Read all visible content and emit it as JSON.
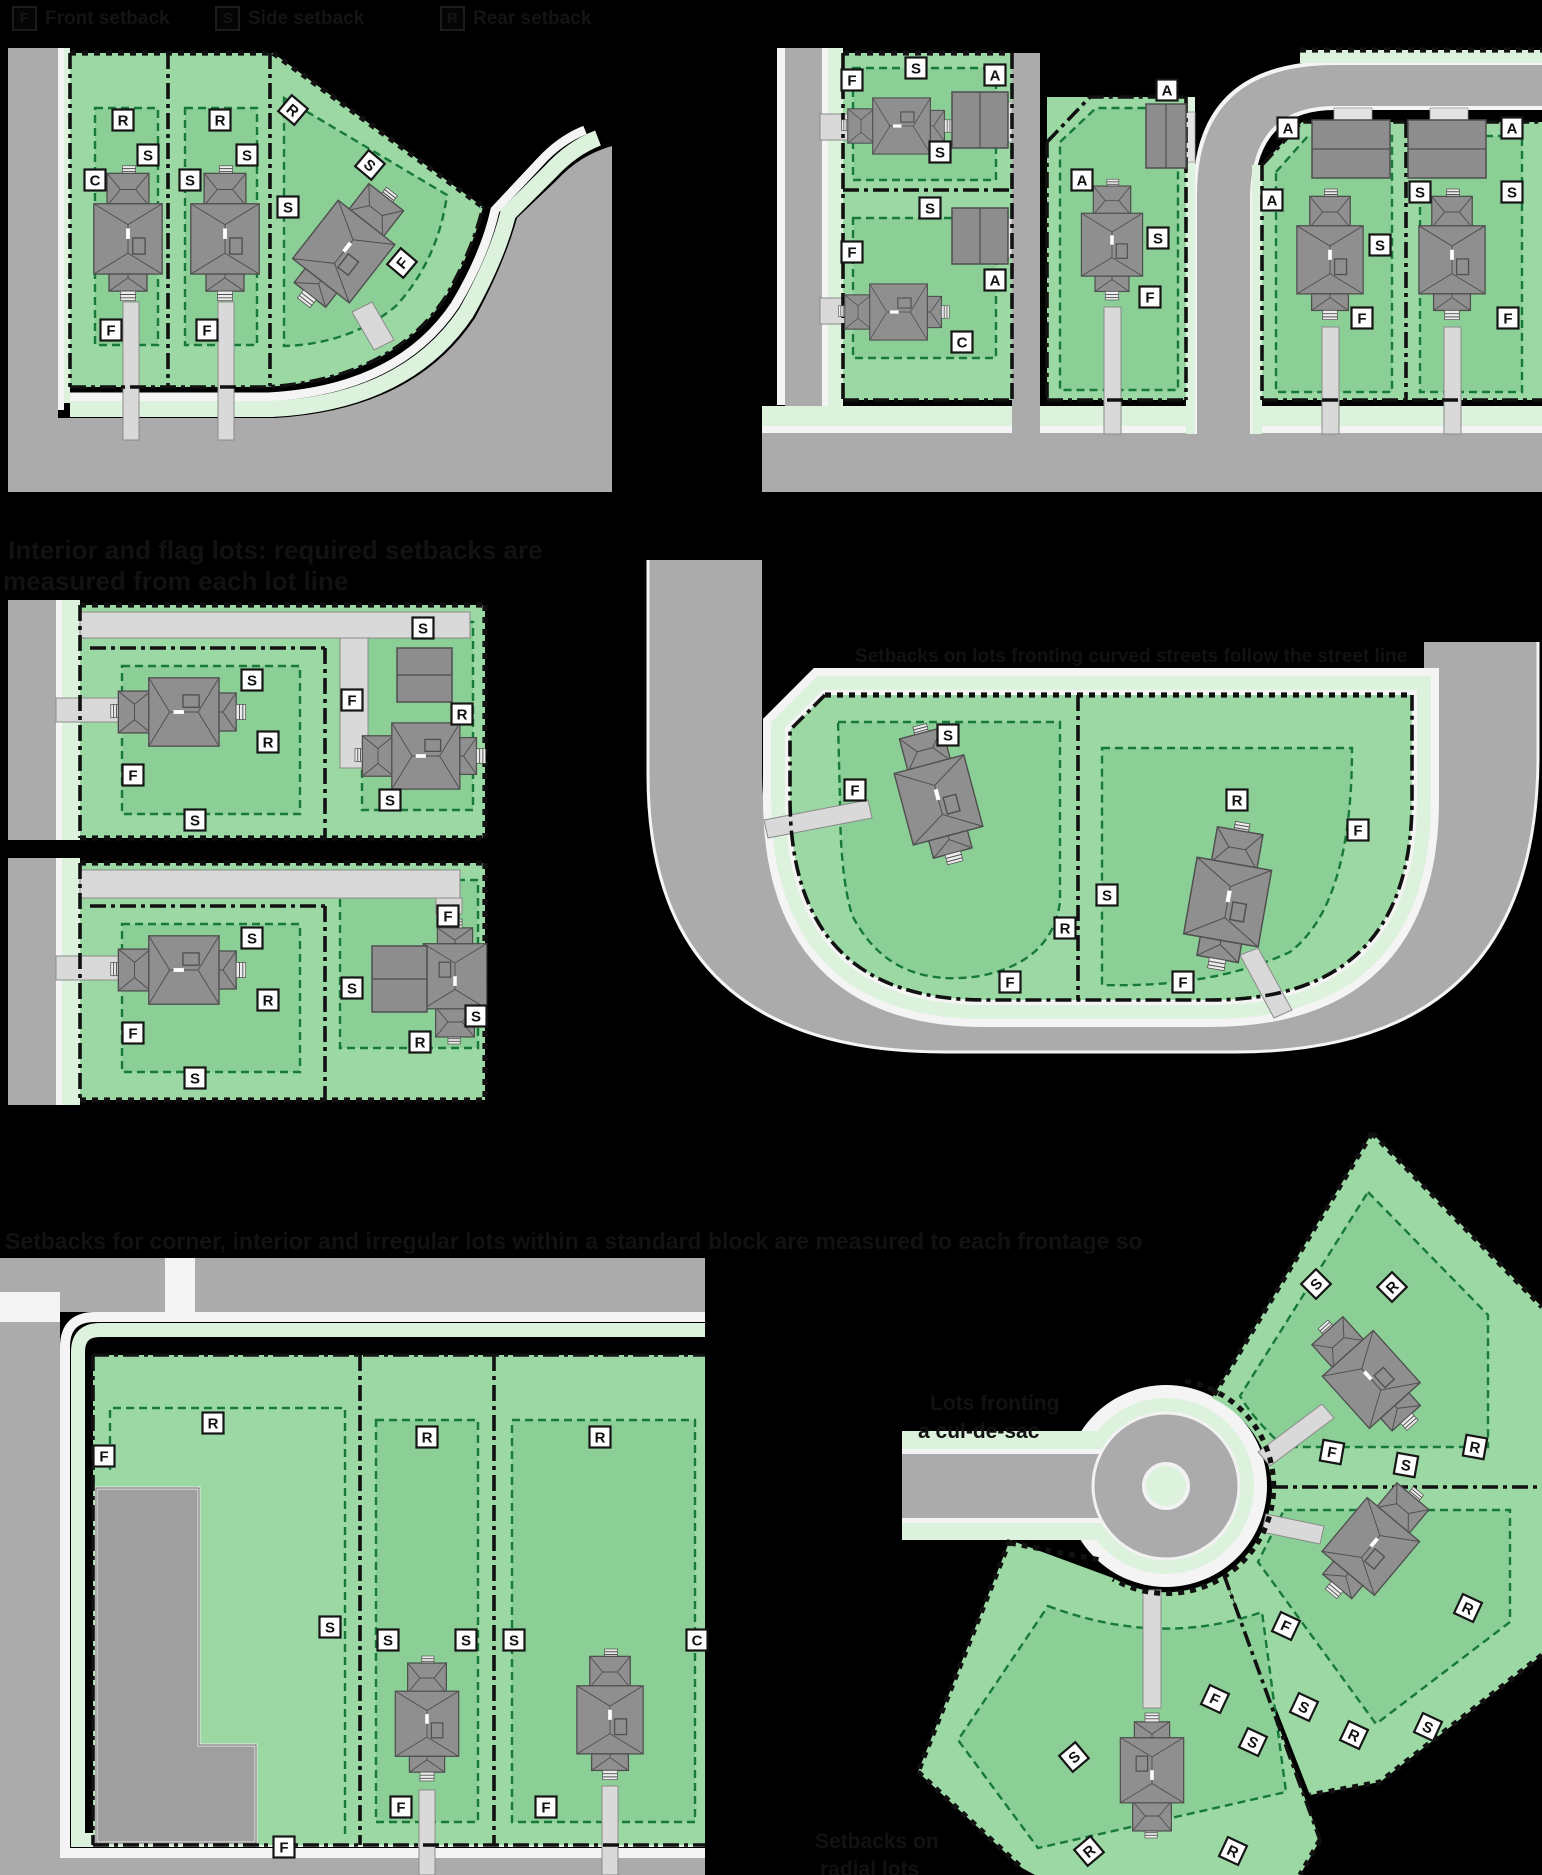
{
  "colors": {
    "background": "#000000",
    "road": "#ababab",
    "lot_green": "#9bd8a3",
    "buildable_green": "#8bcf96",
    "verge_green": "#dcf2dc",
    "sidewalk": "#f4f4f4",
    "setback_dash_green": "#17793a",
    "property_line": "#111111",
    "roof_gray": "#8f8f8f"
  },
  "legend": {
    "items": [
      {
        "letter": "F",
        "label": "Front setback",
        "left": 12
      },
      {
        "letter": "S",
        "label": "Side setback",
        "left": 215
      },
      {
        "letter": "R",
        "label": "Rear setback",
        "left": 440
      }
    ]
  },
  "captions": [
    {
      "id": "cap-mid-left-1",
      "text": "Interior and flag lots: required setbacks are",
      "x": 8,
      "y": 535,
      "size": 26
    },
    {
      "id": "cap-mid-left-2",
      "text": "measured from each lot line",
      "x": 3,
      "y": 566,
      "size": 26
    },
    {
      "id": "cap-mid-right",
      "text": "Setbacks on lots fronting curved streets follow the street line",
      "x": 855,
      "y": 646,
      "size": 19
    },
    {
      "id": "cap-bottom-left",
      "text": "Setbacks for corner, interior and irregular lots within a standard block are measured to each frontage so",
      "x": 5,
      "y": 1228,
      "size": 23
    },
    {
      "id": "note-culdesac-1",
      "text": "Lots fronting",
      "x": 930,
      "y": 1392,
      "size": 21
    },
    {
      "id": "note-culdesac-2",
      "text": "a cul-de-sac",
      "x": 918,
      "y": 1420,
      "size": 21
    },
    {
      "id": "note-radial-1",
      "text": "Setbacks on",
      "x": 815,
      "y": 1830,
      "size": 21
    },
    {
      "id": "note-radial-2",
      "text": "radial lots",
      "x": 820,
      "y": 1858,
      "size": 21
    }
  ],
  "panels": [
    {
      "id": "corner-lots",
      "name": "corner-lot-setbacks",
      "labels": [
        {
          "t": "R",
          "x": 123,
          "y": 120
        },
        {
          "t": "S",
          "x": 148,
          "y": 155
        },
        {
          "t": "C",
          "x": 95,
          "y": 180
        },
        {
          "t": "F",
          "x": 111,
          "y": 330
        },
        {
          "t": "R",
          "x": 220,
          "y": 120
        },
        {
          "t": "S",
          "x": 247,
          "y": 155
        },
        {
          "t": "S",
          "x": 190,
          "y": 180
        },
        {
          "t": "F",
          "x": 207,
          "y": 330
        },
        {
          "t": "R",
          "x": 293,
          "y": 110,
          "r": 40
        },
        {
          "t": "S",
          "x": 370,
          "y": 165,
          "r": 40
        },
        {
          "t": "S",
          "x": 288,
          "y": 207
        },
        {
          "t": "F",
          "x": 402,
          "y": 263,
          "r": -50
        }
      ],
      "houses": [
        {
          "x": 128,
          "y": 237,
          "r": 0,
          "s": 0.95
        },
        {
          "x": 225,
          "y": 237,
          "r": 0,
          "s": 0.95
        },
        {
          "x": 345,
          "y": 250,
          "r": 38,
          "s": 1.0
        }
      ],
      "garages": []
    },
    {
      "id": "alley-lots",
      "name": "alley-loaded-lot-setbacks",
      "labels": [
        {
          "t": "F",
          "x": 852,
          "y": 80
        },
        {
          "t": "S",
          "x": 916,
          "y": 68
        },
        {
          "t": "A",
          "x": 995,
          "y": 75
        },
        {
          "t": "S",
          "x": 940,
          "y": 152
        },
        {
          "t": "S",
          "x": 930,
          "y": 208
        },
        {
          "t": "F",
          "x": 852,
          "y": 252
        },
        {
          "t": "A",
          "x": 995,
          "y": 280
        },
        {
          "t": "C",
          "x": 962,
          "y": 342
        },
        {
          "t": "A",
          "x": 1082,
          "y": 180
        },
        {
          "t": "A",
          "x": 1167,
          "y": 90
        },
        {
          "t": "S",
          "x": 1158,
          "y": 238
        },
        {
          "t": "F",
          "x": 1150,
          "y": 297
        },
        {
          "t": "A",
          "x": 1288,
          "y": 128
        },
        {
          "t": "A",
          "x": 1272,
          "y": 200
        },
        {
          "t": "S",
          "x": 1380,
          "y": 245
        },
        {
          "t": "F",
          "x": 1362,
          "y": 318
        },
        {
          "t": "A",
          "x": 1512,
          "y": 128
        },
        {
          "t": "S",
          "x": 1420,
          "y": 192
        },
        {
          "t": "S",
          "x": 1512,
          "y": 192
        },
        {
          "t": "F",
          "x": 1508,
          "y": 318
        }
      ],
      "houses": [
        {
          "x": 900,
          "y": 126,
          "r": -90,
          "s": 0.78
        },
        {
          "x": 897,
          "y": 312,
          "r": -90,
          "s": 0.78
        },
        {
          "x": 1112,
          "y": 243,
          "r": 0,
          "s": 0.85
        },
        {
          "x": 1330,
          "y": 258,
          "r": 0,
          "s": 0.92
        },
        {
          "x": 1452,
          "y": 258,
          "r": 0,
          "s": 0.92
        }
      ],
      "garages": [
        {
          "x": 952,
          "y": 92,
          "w": 56,
          "h": 56,
          "line": "v"
        },
        {
          "x": 952,
          "y": 208,
          "w": 56,
          "h": 56,
          "line": "v"
        },
        {
          "x": 1146,
          "y": 104,
          "w": 40,
          "h": 64,
          "line": "v"
        },
        {
          "x": 1312,
          "y": 120,
          "w": 78,
          "h": 58,
          "line": "h"
        },
        {
          "x": 1408,
          "y": 120,
          "w": 78,
          "h": 58,
          "line": "h"
        }
      ]
    },
    {
      "id": "flag-lot-a",
      "name": "flag-lot-setbacks-a",
      "labels": [
        {
          "t": "S",
          "x": 252,
          "y": 680
        },
        {
          "t": "R",
          "x": 268,
          "y": 742
        },
        {
          "t": "F",
          "x": 133,
          "y": 775
        },
        {
          "t": "S",
          "x": 195,
          "y": 820
        },
        {
          "t": "S",
          "x": 423,
          "y": 628
        },
        {
          "t": "F",
          "x": 352,
          "y": 700
        },
        {
          "t": "R",
          "x": 462,
          "y": 714
        },
        {
          "t": "S",
          "x": 390,
          "y": 800
        }
      ],
      "houses": [
        {
          "x": 182,
          "y": 712,
          "r": -90,
          "s": 0.95
        },
        {
          "x": 424,
          "y": 756,
          "r": -90,
          "s": 0.92
        }
      ],
      "garages": [
        {
          "x": 397,
          "y": 648,
          "w": 55,
          "h": 54,
          "line": "h"
        }
      ]
    },
    {
      "id": "flag-lot-b",
      "name": "flag-lot-setbacks-b",
      "labels": [
        {
          "t": "S",
          "x": 252,
          "y": 938
        },
        {
          "t": "R",
          "x": 268,
          "y": 1000
        },
        {
          "t": "F",
          "x": 133,
          "y": 1033
        },
        {
          "t": "S",
          "x": 195,
          "y": 1078
        },
        {
          "t": "F",
          "x": 448,
          "y": 916
        },
        {
          "t": "S",
          "x": 352,
          "y": 988
        },
        {
          "t": "R",
          "x": 420,
          "y": 1042
        },
        {
          "t": "S",
          "x": 476,
          "y": 1016
        }
      ],
      "houses": [
        {
          "x": 182,
          "y": 970,
          "r": -90,
          "s": 0.95
        },
        {
          "x": 455,
          "y": 978,
          "r": 180,
          "s": 0.88
        }
      ],
      "garages": [
        {
          "x": 372,
          "y": 946,
          "w": 55,
          "h": 66,
          "line": "h"
        }
      ]
    },
    {
      "id": "curve-lots",
      "name": "curved-street-lot-setbacks",
      "labels": [
        {
          "t": "S",
          "x": 948,
          "y": 735
        },
        {
          "t": "F",
          "x": 855,
          "y": 790
        },
        {
          "t": "R",
          "x": 1065,
          "y": 928
        },
        {
          "t": "F",
          "x": 1010,
          "y": 982
        },
        {
          "t": "R",
          "x": 1237,
          "y": 800
        },
        {
          "t": "F",
          "x": 1358,
          "y": 830
        },
        {
          "t": "S",
          "x": 1107,
          "y": 895
        },
        {
          "t": "F",
          "x": 1183,
          "y": 982
        }
      ],
      "houses": [
        {
          "x": 938,
          "y": 798,
          "r": -15,
          "s": 1.0
        },
        {
          "x": 1228,
          "y": 900,
          "r": 10,
          "s": 1.05
        }
      ],
      "garages": []
    },
    {
      "id": "block-lots",
      "name": "block-interior-lot-setbacks",
      "labels": [
        {
          "t": "R",
          "x": 213,
          "y": 1423
        },
        {
          "t": "F",
          "x": 104,
          "y": 1456
        },
        {
          "t": "S",
          "x": 330,
          "y": 1627
        },
        {
          "t": "F",
          "x": 284,
          "y": 1847
        },
        {
          "t": "R",
          "x": 427,
          "y": 1437
        },
        {
          "t": "S",
          "x": 388,
          "y": 1640
        },
        {
          "t": "S",
          "x": 466,
          "y": 1640
        },
        {
          "t": "F",
          "x": 401,
          "y": 1807
        },
        {
          "t": "R",
          "x": 600,
          "y": 1437
        },
        {
          "t": "S",
          "x": 514,
          "y": 1640
        },
        {
          "t": "C",
          "x": 697,
          "y": 1640
        },
        {
          "t": "F",
          "x": 546,
          "y": 1807
        }
      ],
      "houses": [
        {
          "x": 427,
          "y": 1722,
          "r": 0,
          "s": 0.88
        },
        {
          "x": 610,
          "y": 1718,
          "r": 0,
          "s": 0.92
        }
      ],
      "garages": []
    },
    {
      "id": "cul-de-sac-lots",
      "name": "cul-de-sac-lot-setbacks",
      "labels": [
        {
          "t": "S",
          "x": 1316,
          "y": 1284,
          "r": -45
        },
        {
          "t": "R",
          "x": 1392,
          "y": 1287,
          "r": -45
        },
        {
          "t": "F",
          "x": 1332,
          "y": 1452,
          "r": 10
        },
        {
          "t": "S",
          "x": 1406,
          "y": 1465,
          "r": 10
        },
        {
          "t": "R",
          "x": 1475,
          "y": 1447,
          "r": 10
        },
        {
          "t": "F",
          "x": 1286,
          "y": 1626,
          "r": 25
        },
        {
          "t": "S",
          "x": 1304,
          "y": 1707,
          "r": 25
        },
        {
          "t": "R",
          "x": 1354,
          "y": 1735,
          "r": 25
        },
        {
          "t": "S",
          "x": 1428,
          "y": 1727,
          "r": 25
        },
        {
          "t": "R",
          "x": 1468,
          "y": 1608,
          "r": 25
        },
        {
          "t": "S",
          "x": 1074,
          "y": 1757,
          "r": -40
        },
        {
          "t": "R",
          "x": 1089,
          "y": 1851,
          "r": -40
        },
        {
          "t": "F",
          "x": 1215,
          "y": 1699,
          "r": 25
        },
        {
          "t": "S",
          "x": 1253,
          "y": 1742,
          "r": 25
        },
        {
          "t": "R",
          "x": 1233,
          "y": 1851,
          "r": 25
        }
      ],
      "houses": [
        {
          "x": 1370,
          "y": 1378,
          "r": -42,
          "s": 0.95
        },
        {
          "x": 1372,
          "y": 1545,
          "r": 40,
          "s": 0.95
        },
        {
          "x": 1152,
          "y": 1772,
          "r": 180,
          "s": 0.88
        }
      ],
      "garages": []
    }
  ]
}
